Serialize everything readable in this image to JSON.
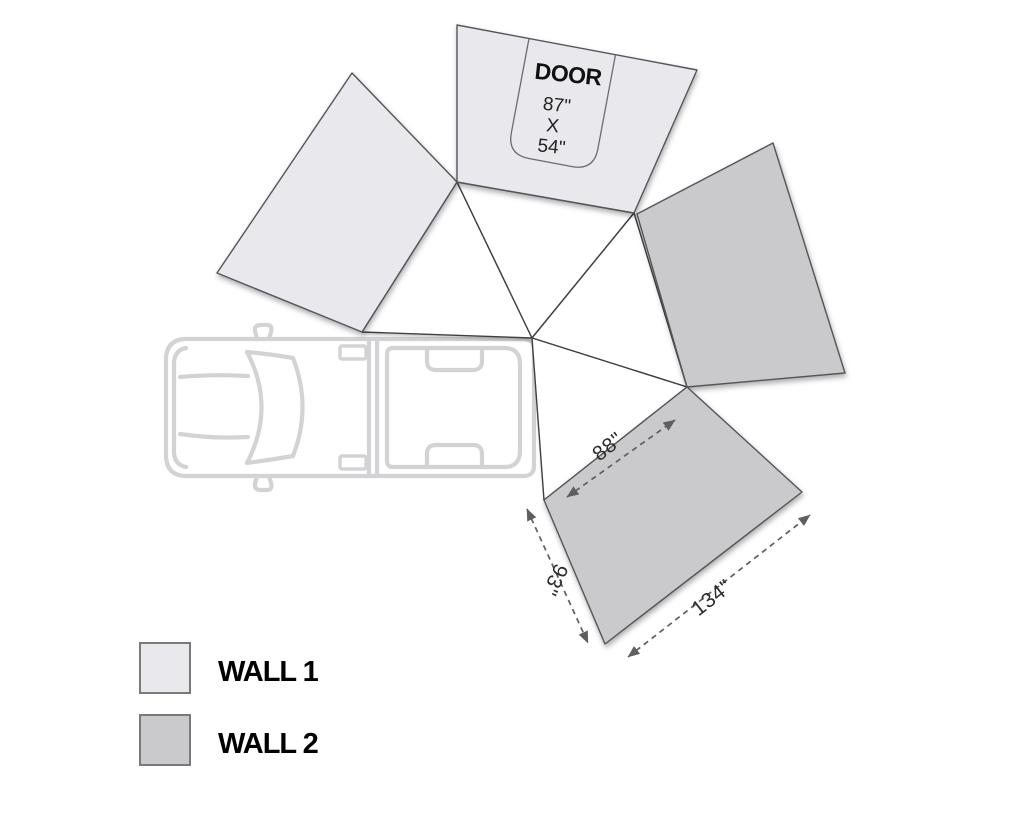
{
  "diagram": {
    "door": {
      "label": "DOOR",
      "line1": "87\"",
      "line2": "X",
      "line3": "54\""
    },
    "dimensions": {
      "top_edge": "88\"",
      "left_edge": "93\"",
      "bottom_edge": "134\""
    }
  },
  "legend": {
    "items": [
      {
        "label": "WALL 1",
        "color_key": "wall1"
      },
      {
        "label": "WALL 2",
        "color_key": "wall2"
      }
    ]
  },
  "colors": {
    "wall1": "#e9e9ed",
    "wall2": "#cacacc",
    "canopy": "#ffffff",
    "edge": "#4f4f52",
    "dimension": "#5f5f5f",
    "vehicle_outline": "#d3d3d5",
    "label_text": "#000000"
  },
  "icons": {
    "vehicle": "pickup-truck-top-view-icon",
    "arrows": "double-headed-dashed-arrow"
  }
}
